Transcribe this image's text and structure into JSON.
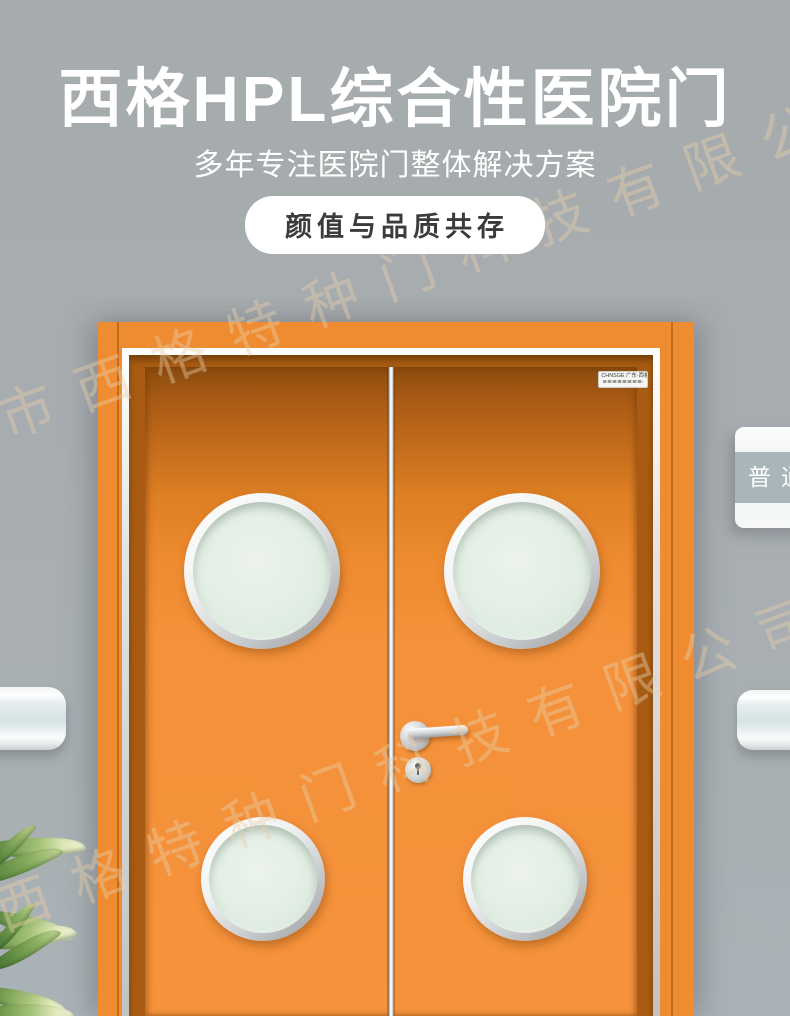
{
  "header": {
    "title": "西格HPL综合性医院门",
    "subtitle": "多年专注医院门整体解决方案",
    "badge": "颜值与品质共存"
  },
  "door": {
    "brand_label": "CHNSGE 广东·西格",
    "colors": {
      "frame": "#ef8b31",
      "leaf": "#f5923b",
      "jamb": "#a85c13",
      "glass": "#e2eee4",
      "hardware": "#cfd3d5"
    },
    "window_count": 4
  },
  "sign": {
    "label": "普通",
    "band_color": "#a9b6b9"
  },
  "watermark": {
    "text": "佛山市西格特种门科技有限公司",
    "color": "#e9cfa9"
  },
  "wall": {
    "color": "#a7acb0"
  }
}
